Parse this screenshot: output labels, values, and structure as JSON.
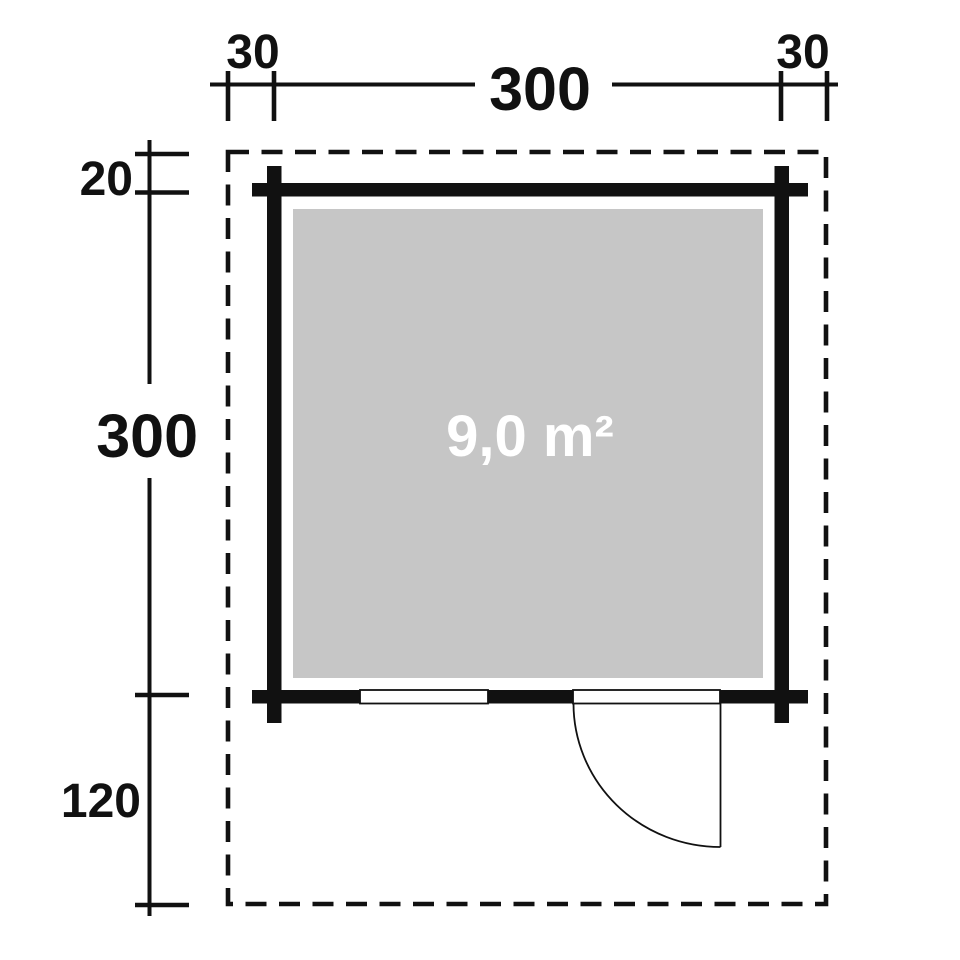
{
  "diagram": {
    "dims": {
      "overhang_left": "30",
      "width": "300",
      "overhang_right": "30",
      "overhang_rear": "20",
      "depth": "300",
      "overhang_front": "120"
    },
    "area_label": "9,0 m²",
    "colors": {
      "line": "#111111",
      "interior_fill": "#c6c6c6",
      "area_text": "#ffffff",
      "background": "#ffffff"
    }
  }
}
